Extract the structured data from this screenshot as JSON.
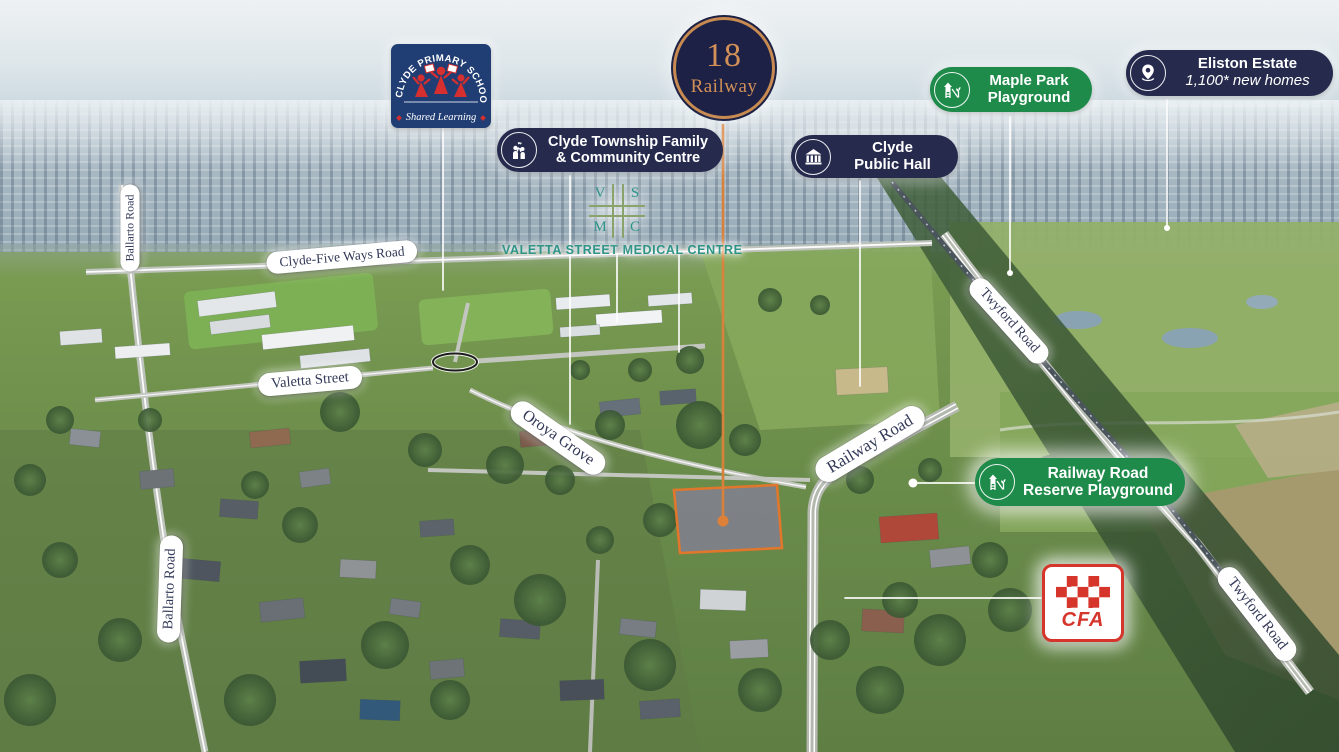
{
  "badge": {
    "number": "18",
    "name": "Railway"
  },
  "landmarks": {
    "school": {
      "arc": "CLYDE PRIMARY SCHOOL",
      "tagline": "Shared Learning"
    },
    "community": {
      "line1": "Clyde Township Family",
      "line2": "& Community Centre"
    },
    "medical": {
      "v": "V",
      "s": "S",
      "m": "M",
      "c": "C",
      "label": "VALETTA STREET MEDICAL CENTRE"
    },
    "maple": {
      "line1": "Maple Park",
      "line2": "Playground"
    },
    "eliston": {
      "line1": "Eliston Estate",
      "line2": "1,100* new homes"
    },
    "hall": {
      "line1": "Clyde",
      "line2": "Public Hall"
    },
    "reserve": {
      "line1": "Railway Road",
      "line2": "Reserve Playground"
    },
    "cfa": {
      "label": "CFA"
    }
  },
  "roads": {
    "ballarto_top": "Ballarto Road",
    "ballarto_bottom": "Ballarto Road",
    "clyde_five_ways": "Clyde-Five Ways Road",
    "valetta": "Valetta Street",
    "oroya": "Oroya Grove",
    "railway": "Railway Road",
    "twyford_top": "Twyford Road",
    "twyford_bottom": "Twyford Road"
  },
  "colors": {
    "navy": "#262b4e",
    "green": "#1f8b4a",
    "orange": "#d9813a",
    "teal": "#2f9488",
    "cfa_red": "#d6352c",
    "school_navy": "#203d74"
  }
}
